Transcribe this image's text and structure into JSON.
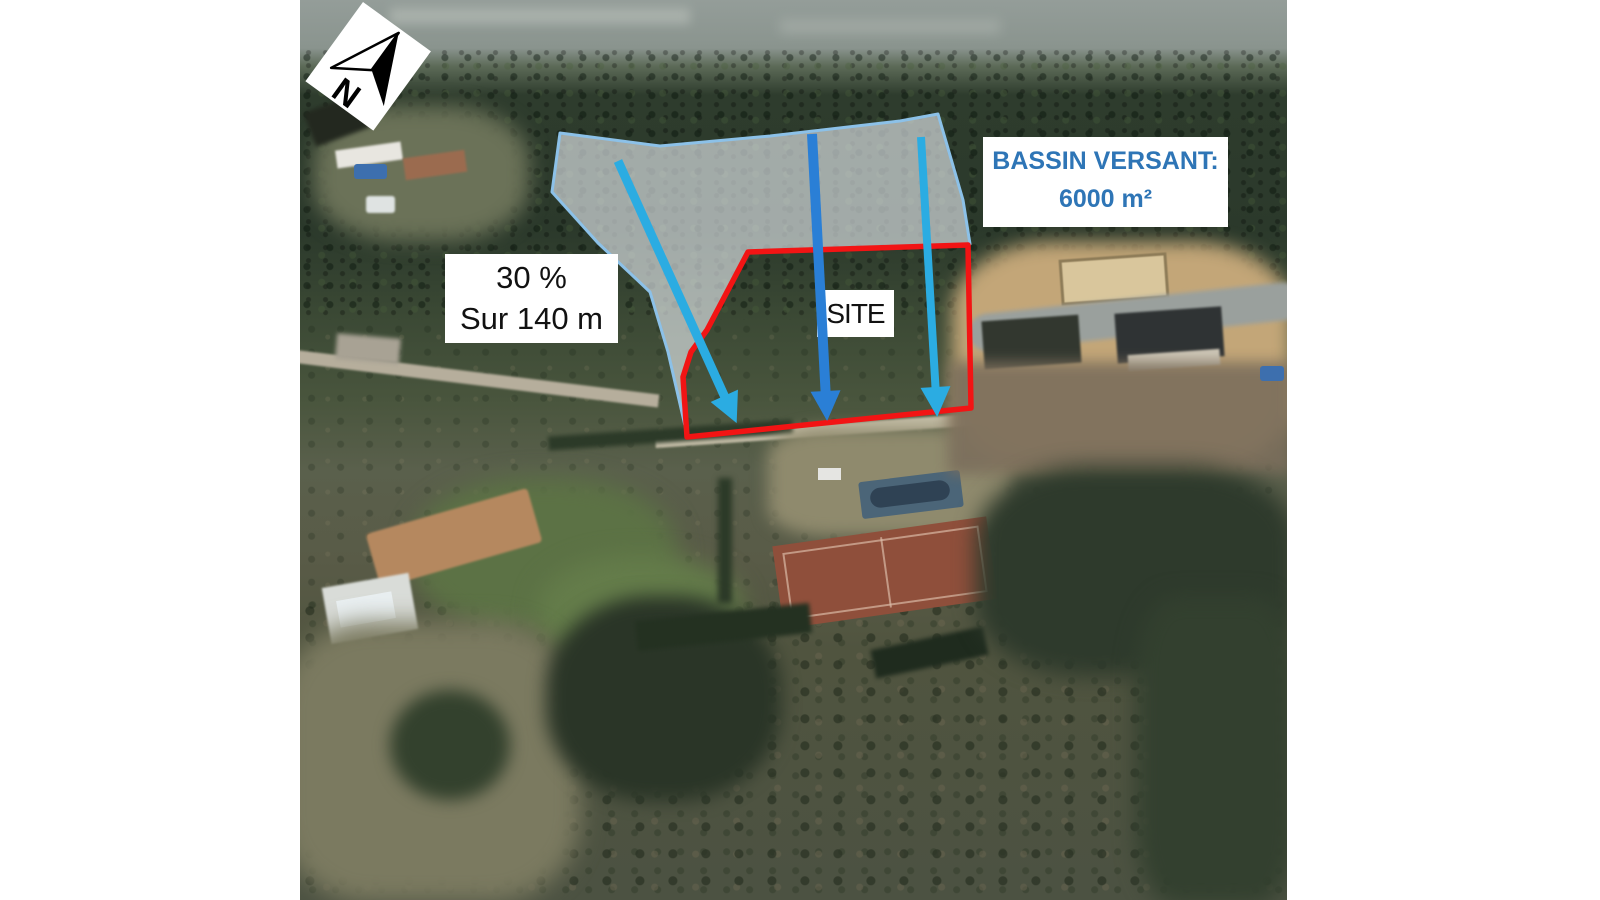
{
  "annotations": {
    "compass": {
      "letter": "N"
    },
    "slope_box": {
      "line1": "30 %",
      "line2": "Sur 140 m"
    },
    "site_box": {
      "label": "SITE"
    },
    "watershed_box": {
      "line1": "BASSIN VERSANT:",
      "line2": "6000 m²"
    }
  },
  "colors": {
    "site_outline_red": "#F21414",
    "runoff_arrow_light": "#2BACE2",
    "runoff_arrow_dark": "#2A7FD6",
    "watershed_border": "#8CC1E8",
    "watershed_fill": "rgba(236,240,245,0.62)",
    "watershed_text_blue": "#2E75B6",
    "label_text": "#111111",
    "page_background": "#FFFFFF"
  }
}
